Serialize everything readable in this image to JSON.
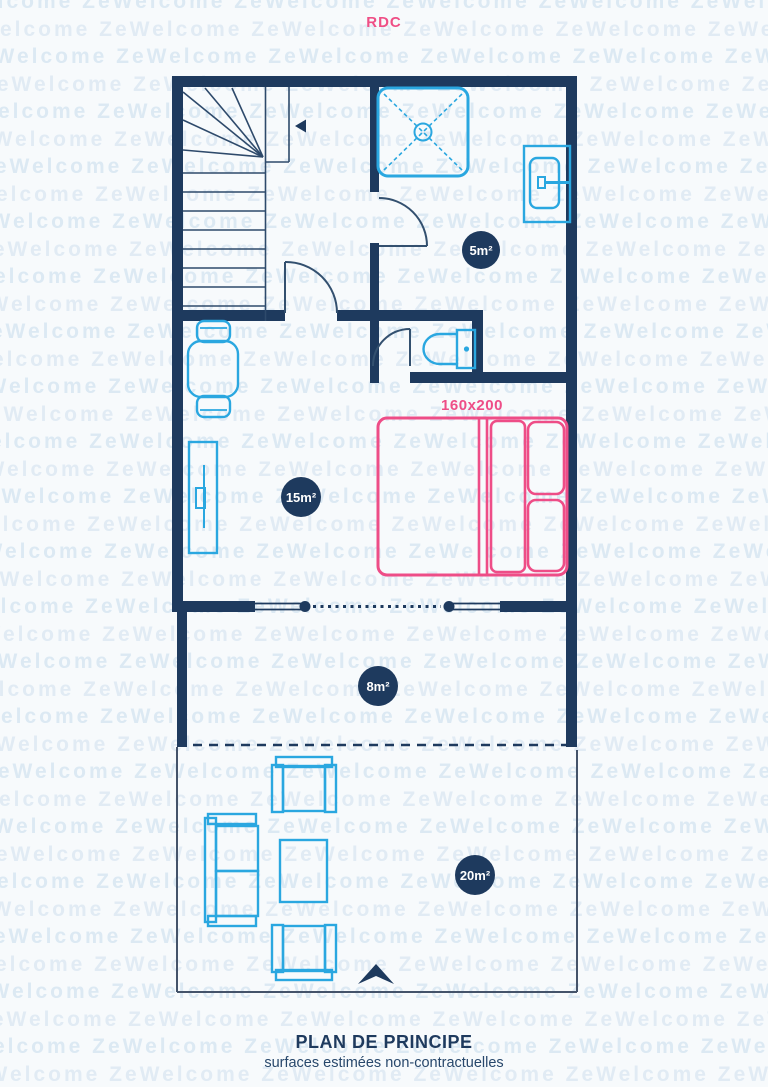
{
  "title": "RDC",
  "watermark": {
    "text": "ZeWelcome",
    "repeat_per_row": 8,
    "rows": 40
  },
  "colors": {
    "wall": "#1e3a5e",
    "door": "#33506f",
    "stair_line": "#2e4a6b",
    "fixture_cyan": "#2aa7e0",
    "accent_pink": "#ee4d87",
    "badge_bg": "#1e3a5e",
    "badge_text": "#ffffff",
    "terrace_line": "#44536a",
    "watermark": "#d3e4f1",
    "background": "#f7fafc"
  },
  "rooms": [
    {
      "name": "bathroom",
      "area_label": "5m²"
    },
    {
      "name": "living-kitchen",
      "area_label": "15m²"
    },
    {
      "name": "balcony",
      "area_label": "8m²"
    },
    {
      "name": "terrace",
      "area_label": "20m²"
    }
  ],
  "bed": {
    "size_label": "160x200"
  },
  "caption": {
    "title": "PLAN DE PRINCIPE",
    "subtitle": "surfaces estimées non-contractuelles"
  }
}
